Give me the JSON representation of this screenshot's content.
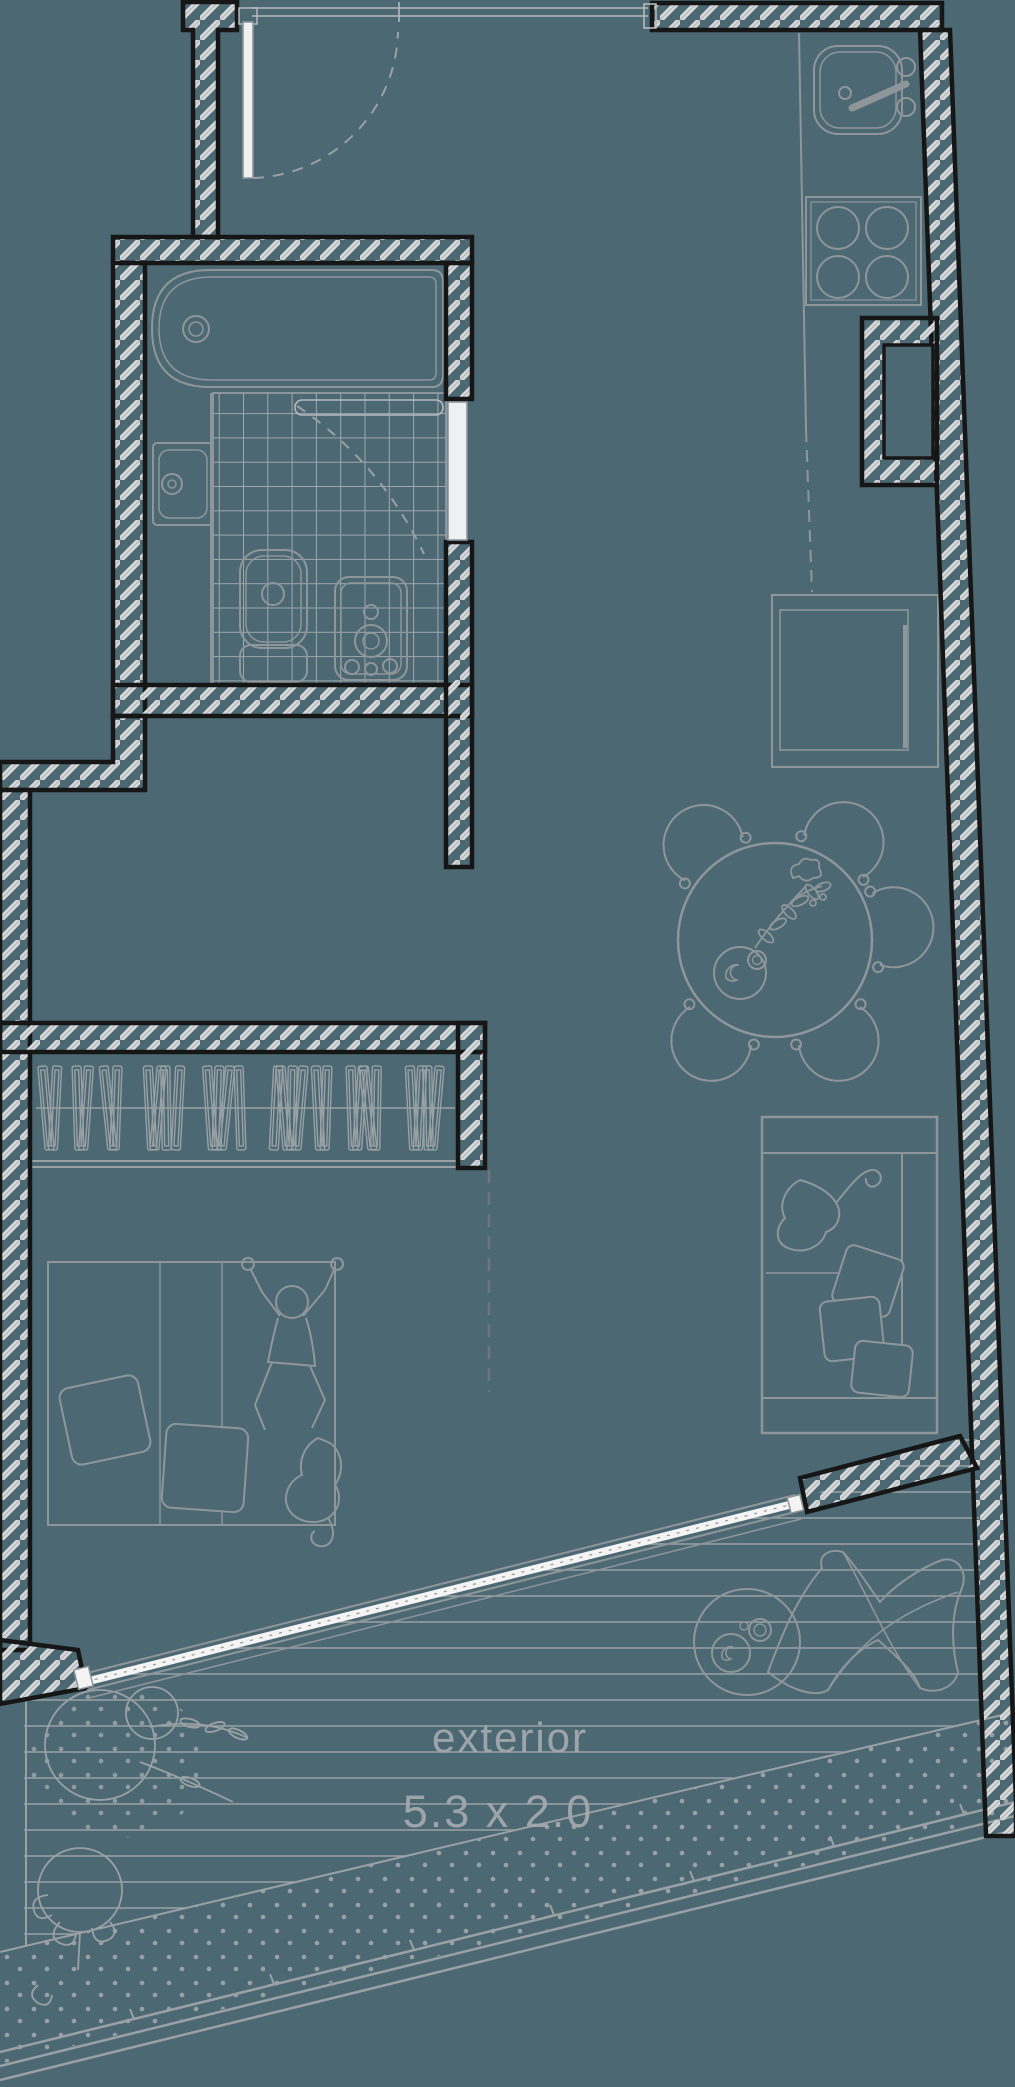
{
  "page": {
    "background": "#4c6973"
  },
  "palette": {
    "wall_hatch": "#d7d9da",
    "wall_outline": "#161616",
    "furniture_line": "#8f969a",
    "light_line": "#b4babd",
    "text_color": "#a3a9ad",
    "glass_white": "#f4f4f4"
  },
  "terrace": {
    "label": "exterior",
    "dimensions": "5.3 x 2.0"
  }
}
